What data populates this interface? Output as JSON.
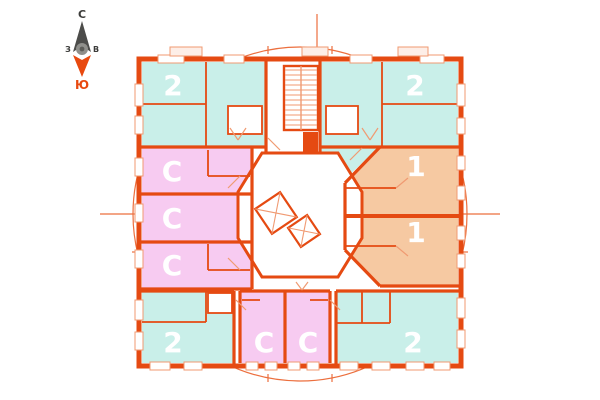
{
  "compass": {
    "north_label": "С",
    "south_label": "Ю",
    "west_label": "З",
    "east_label": "В"
  },
  "colors": {
    "wall": "#e54a12",
    "wall_light": "#f09a72",
    "two_room_fill": "#c9efe9",
    "studio_fill": "#f7cbf1",
    "one_room_fill": "#f6c9a2",
    "circle": "#ec6f3e",
    "balcony_fill": "#fdeee7",
    "compass_north": "#4c4c4a",
    "compass_south": "#e8490f",
    "label_text": "#ffffff"
  },
  "units": [
    {
      "id": "apt-2-top-left",
      "label": "2",
      "type": "2-room"
    },
    {
      "id": "apt-2-top-right",
      "label": "2",
      "type": "2-room"
    },
    {
      "id": "apt-1-right-upper",
      "label": "1",
      "type": "1-room"
    },
    {
      "id": "apt-1-right-lower",
      "label": "1",
      "type": "1-room"
    },
    {
      "id": "studio-left-1",
      "label": "С",
      "type": "studio"
    },
    {
      "id": "studio-left-2",
      "label": "С",
      "type": "studio"
    },
    {
      "id": "studio-left-3",
      "label": "С",
      "type": "studio"
    },
    {
      "id": "apt-2-bottom-left",
      "label": "2",
      "type": "2-room"
    },
    {
      "id": "studio-bottom-1",
      "label": "С",
      "type": "studio"
    },
    {
      "id": "studio-bottom-2",
      "label": "С",
      "type": "studio"
    },
    {
      "id": "apt-2-bottom-right",
      "label": "2",
      "type": "2-room"
    }
  ]
}
